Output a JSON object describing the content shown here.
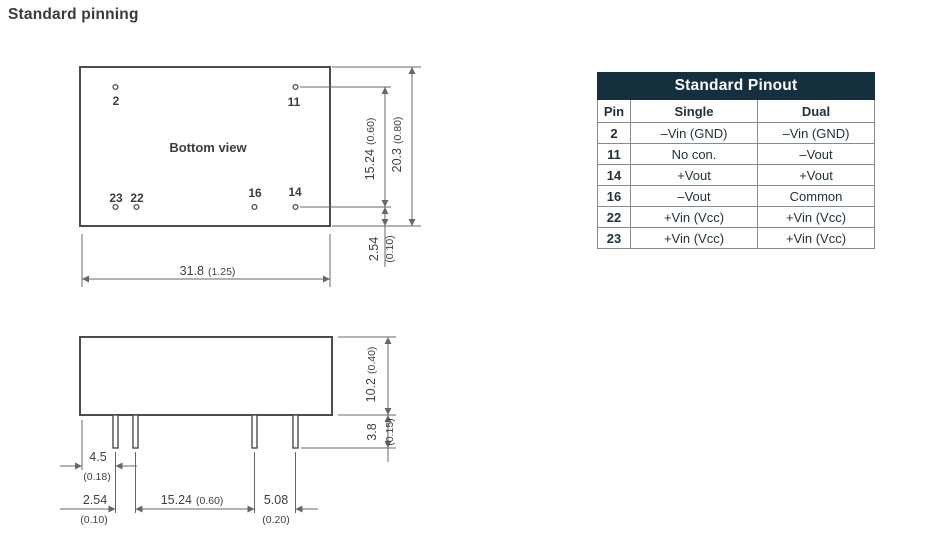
{
  "page": {
    "title": "Standard pinning"
  },
  "colors": {
    "table_header_bg": "#14303e",
    "table_header_text": "#ffffff",
    "table_border": "#8a8a8a",
    "drawing_line": "#4c4c4c",
    "dimension_line": "#676767"
  },
  "bottom_view": {
    "label": "Bottom view",
    "pin_labels": {
      "p2": "2",
      "p11": "11",
      "p23": "23",
      "p22": "22",
      "p16": "16",
      "p14": "14"
    },
    "dims": {
      "pin_rows": {
        "mm": "15.24",
        "inch": "(0.60)"
      },
      "body_height": {
        "mm": "20.3",
        "inch": "(0.80)"
      },
      "pin_offset": {
        "mm": "2.54",
        "inch": "(0.10)"
      },
      "body_width": {
        "mm": "31.8",
        "inch": "(1.25)"
      }
    }
  },
  "side_view": {
    "dims": {
      "body_height": {
        "mm": "10.2",
        "inch": "(0.40)"
      },
      "pin_length": {
        "mm": "3.8",
        "inch": "(0.15)"
      },
      "pin1_offset": {
        "mm": "4.5",
        "inch": "(0.18)"
      },
      "pin_pitch": {
        "mm": "2.54",
        "inch": "(0.10)"
      },
      "pin_span": {
        "mm": "15.24",
        "inch": "(0.60)"
      },
      "out_pin_gap": {
        "mm": "5.08",
        "inch": "(0.20)"
      }
    }
  },
  "pinout_table": {
    "title": "Standard Pinout",
    "columns": {
      "pin": "Pin",
      "single": "Single",
      "dual": "Dual"
    },
    "rows": [
      {
        "pin": "2",
        "single": "–Vin (GND)",
        "dual": "–Vin (GND)"
      },
      {
        "pin": "11",
        "single": "No con.",
        "dual": "–Vout"
      },
      {
        "pin": "14",
        "single": "+Vout",
        "dual": "+Vout"
      },
      {
        "pin": "16",
        "single": "–Vout",
        "dual": "Common"
      },
      {
        "pin": "22",
        "single": "+Vin (Vcc)",
        "dual": "+Vin (Vcc)"
      },
      {
        "pin": "23",
        "single": "+Vin (Vcc)",
        "dual": "+Vin (Vcc)"
      }
    ]
  }
}
